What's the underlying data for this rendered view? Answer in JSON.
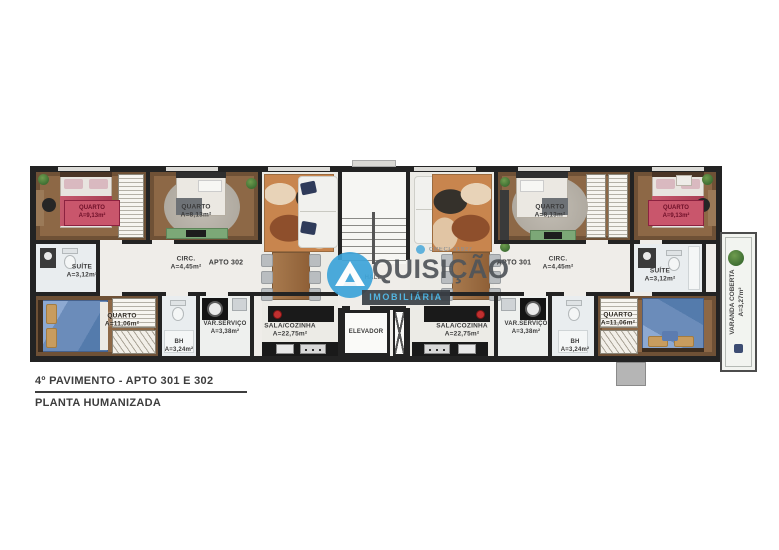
{
  "title_block": {
    "line1": "4º PAVIMENTO - APTO 301 E 302",
    "line2": "PLANTA HUMANIZADA"
  },
  "watermark": {
    "brand_main": "QUISIÇÃO",
    "brand_sub": "IMOBILIÁRIA",
    "creci": "CRECI 31927"
  },
  "core": {
    "elevator_label": "ELEVADOR",
    "hall_label": "HALL"
  },
  "apto302": {
    "label": "APTO 302",
    "circ": {
      "name": "CIRC.",
      "area": "A=4,45m²"
    },
    "quarto1": {
      "name": "QUARTO",
      "area": "A=9,13m²"
    },
    "quarto2": {
      "name": "QUARTO",
      "area": "A=8,13m²"
    },
    "suite": {
      "name": "SUÍTE",
      "area": "A=3,12m²"
    },
    "quarto3": {
      "name": "QUARTO",
      "area": "A=11,06m²"
    },
    "bh": {
      "name": "BH",
      "area": "A=3,24m²"
    },
    "var_servico": {
      "name": "VAR.SERVIÇO",
      "area": "A=3,38m²"
    },
    "sala": {
      "name": "SALA/COZINHA",
      "area": "A=22,75m²"
    }
  },
  "apto301": {
    "label": "APTO 301",
    "circ": {
      "name": "CIRC.",
      "area": "A=4,45m²"
    },
    "quarto1": {
      "name": "QUARTO",
      "area": "A=9,13m²"
    },
    "quarto2": {
      "name": "QUARTO",
      "area": "A=8,13m²"
    },
    "suite": {
      "name": "SUÍTE",
      "area": "A=3,12m²"
    },
    "quarto3": {
      "name": "QUARTO",
      "area": "A=11,06m²"
    },
    "bh": {
      "name": "BH",
      "area": "A=3,24m²"
    },
    "var_servico": {
      "name": "VAR.SERVIÇO",
      "area": "A=3,38m²"
    },
    "sala": {
      "name": "SALA/COZINHA",
      "area": "A=22,75m²"
    },
    "varanda": {
      "name": "VARANDA COBERTA",
      "area": "A=3,27m²"
    }
  },
  "colors": {
    "brand_blue": "#3da4d9",
    "badge_red": "#c9566c",
    "wall": "#232323"
  }
}
